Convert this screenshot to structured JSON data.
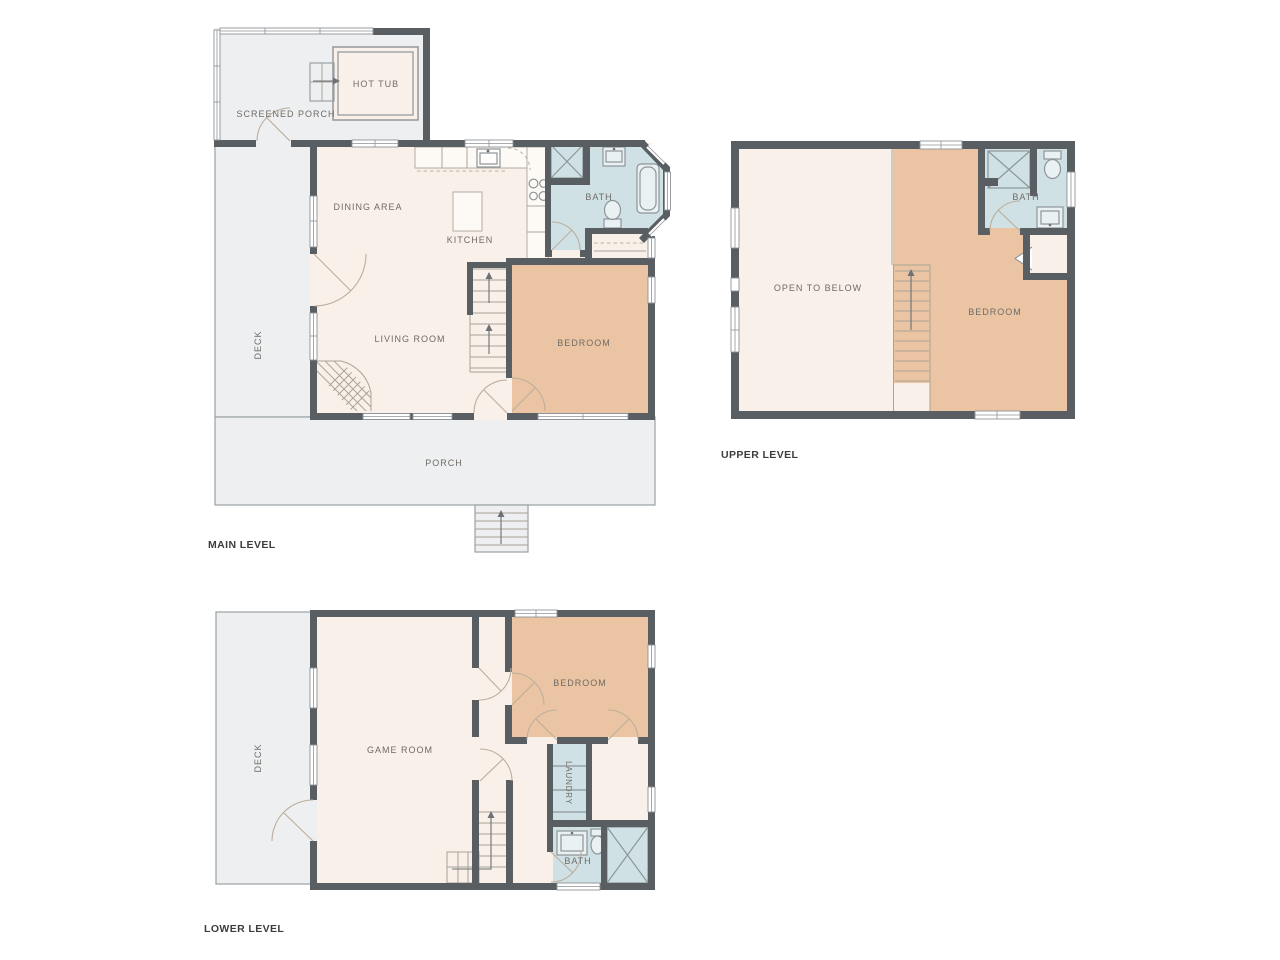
{
  "palette": {
    "wall": "#595e63",
    "floor_living": "#f8f0e9",
    "floor_bedroom": "#ebc5a3",
    "floor_bath": "#cfe1e4",
    "floor_outdoor": "#edeff0"
  },
  "levels": {
    "main": {
      "title": "MAIN LEVEL",
      "rooms": {
        "screened_porch": "SCREENED PORCH",
        "hot_tub": "HOT TUB",
        "deck": "DECK",
        "dining": "DINING AREA",
        "kitchen": "KITCHEN",
        "bath": "BATH",
        "living": "LIVING ROOM",
        "bedroom": "BEDROOM",
        "porch": "PORCH"
      }
    },
    "upper": {
      "title": "UPPER LEVEL",
      "rooms": {
        "open_to_below": "OPEN TO BELOW",
        "bedroom": "BEDROOM",
        "bath": "BATH"
      }
    },
    "lower": {
      "title": "LOWER LEVEL",
      "rooms": {
        "deck": "DECK",
        "game_room": "GAME ROOM",
        "bedroom": "BEDROOM",
        "laundry": "LAUNDRY",
        "bath": "BATH"
      }
    }
  }
}
